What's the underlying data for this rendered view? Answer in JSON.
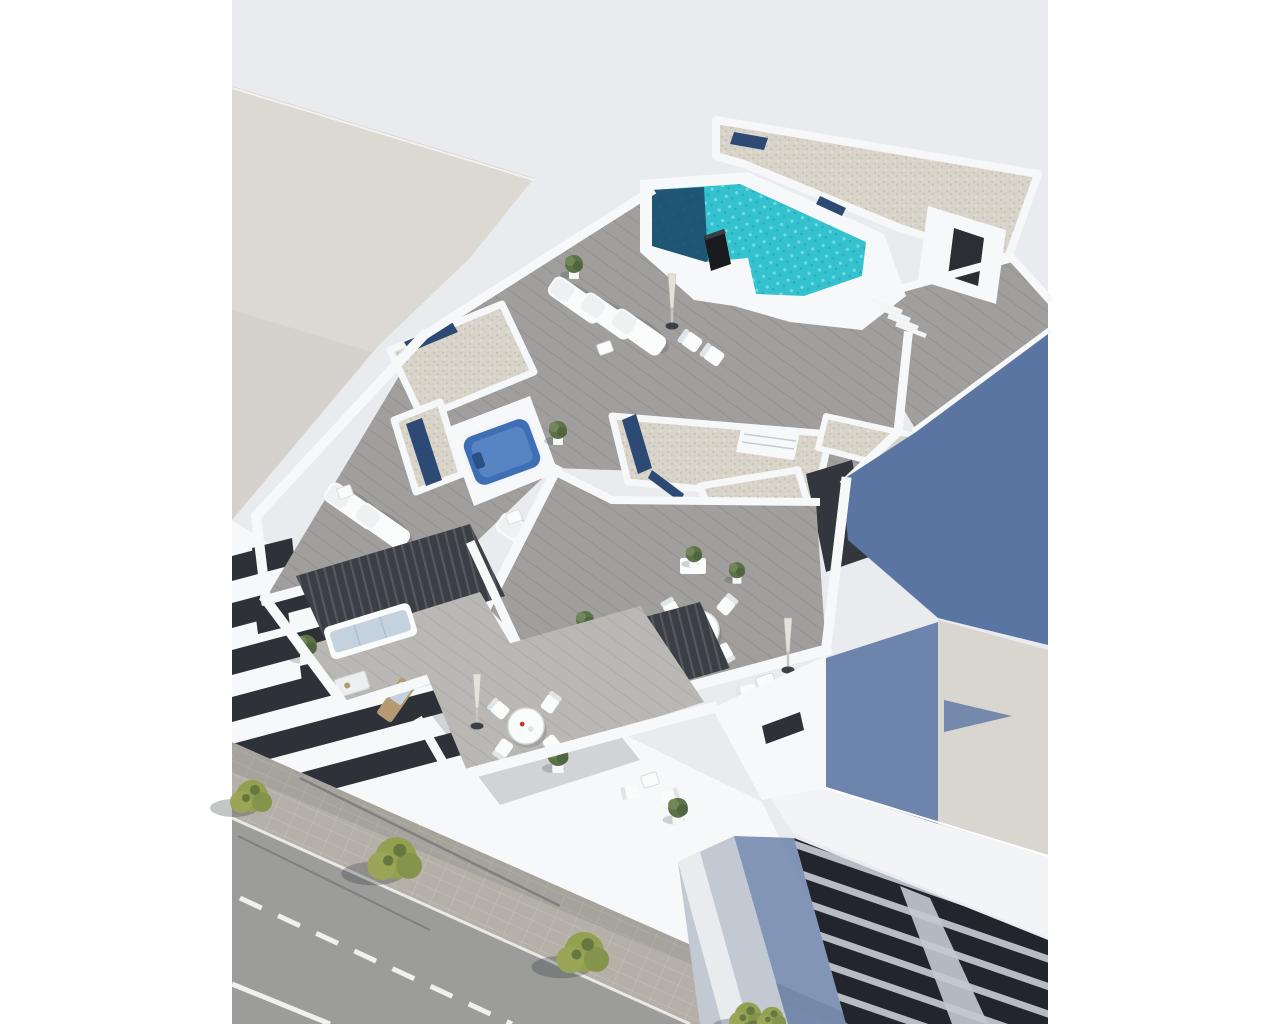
{
  "meta": {
    "title": "Aerial 3D architectural render: white apartment building with rooftop pool, terraces, balconies and street"
  },
  "palette": {
    "page_bg": "#ffffff",
    "backdrop": "#e9ebee",
    "neighbor": "#dcd8d2",
    "neighbor_shade": "#cfccc6",
    "wall": "#f7f8f9",
    "wall_bright": "#fdfdfd",
    "wall_shade": "#d9dce1",
    "deck": "#a09f9d",
    "deck_line": "#8c8b89",
    "deck_light": "#b9b8b5",
    "deck_light_line": "#a6a5a2",
    "gravel": "#d8d4ca",
    "gravel_dot": "#c5bfb2",
    "skylight": "#2c4a74",
    "pool": "#35c2cf",
    "pool_ripple": "#7adfe6",
    "pool_mid": "#2aa9c0",
    "pool_dark": "#1d4a68",
    "hottub": "#3e6fb4",
    "hottub_light": "#6f9bd2",
    "slate": "#5a75a2",
    "slate_low": "#6d84ac",
    "beige_roof": "#d9d6d0",
    "white_roof": "#f3f4f5",
    "dark_facade": "#22262c",
    "slat": "#b7bcc4",
    "corner_wall": "#c3c9d2",
    "recess": "#3b3e44",
    "recess_line": "#55585e",
    "window_dark": "#2e3137",
    "asphalt": "#9c9c9a",
    "sidewalk": "#b4b0a8",
    "paver_line": "#c6c2ba",
    "road_line": "#f0f0ee",
    "tree": "#93a050",
    "tree_dark": "#66773f",
    "plant": "#5d7245",
    "furn": "#fafbfb",
    "cushion": "#c3d2de",
    "wood": "#b59a72",
    "chimney": "#191b1f",
    "red": "#c0392b",
    "shadow": "#2a2d37"
  },
  "scene": {
    "background": {
      "page": "white margins",
      "backdrop": "pale grey render field"
    },
    "neighbor_left": "light plastered building plane at top-left with diagonal roof edge",
    "rooftop": {
      "pool": "L-shaped turquoise pool with dark reflecting end, black chimney column, navy skylight strip and corner steps",
      "gravel_roofs": "white gravel roof decks edged by parapets with navy skylight strips and louvered vents",
      "hot_tub": "square blue jacuzzi inside white enclosure",
      "furniture": [
        "three padded sun loungers",
        "two low deck chairs",
        "folded parasol",
        "side tables",
        "conifer pot"
      ]
    },
    "terraces": {
      "left": "two sun loungers with white side table",
      "middle": "two sun loungers with side table and shrub",
      "dining": "round table with four chairs, small table with two chairs, folded parasol, white planter boxes"
    },
    "balconies": {
      "sofa_balcony": "white corner sofa with pale blue cushions, coffee table, wooden lounger and plant",
      "dining_balcony": "round dining table with chairs, folded parasol, small white table and potted shrubs"
    },
    "street": {
      "road": "grey asphalt with dashed white lane line and solid edge line",
      "sidewalk": "paved band along the facade with street trees and cast shadows"
    },
    "neighbor_right": {
      "shadow_wall": "slate-blue shaded side wall",
      "roof": "beige roof plane with blue shadow wedge",
      "dark_building": "dark louvered facade with light bands beneath a large white roof plane"
    }
  }
}
